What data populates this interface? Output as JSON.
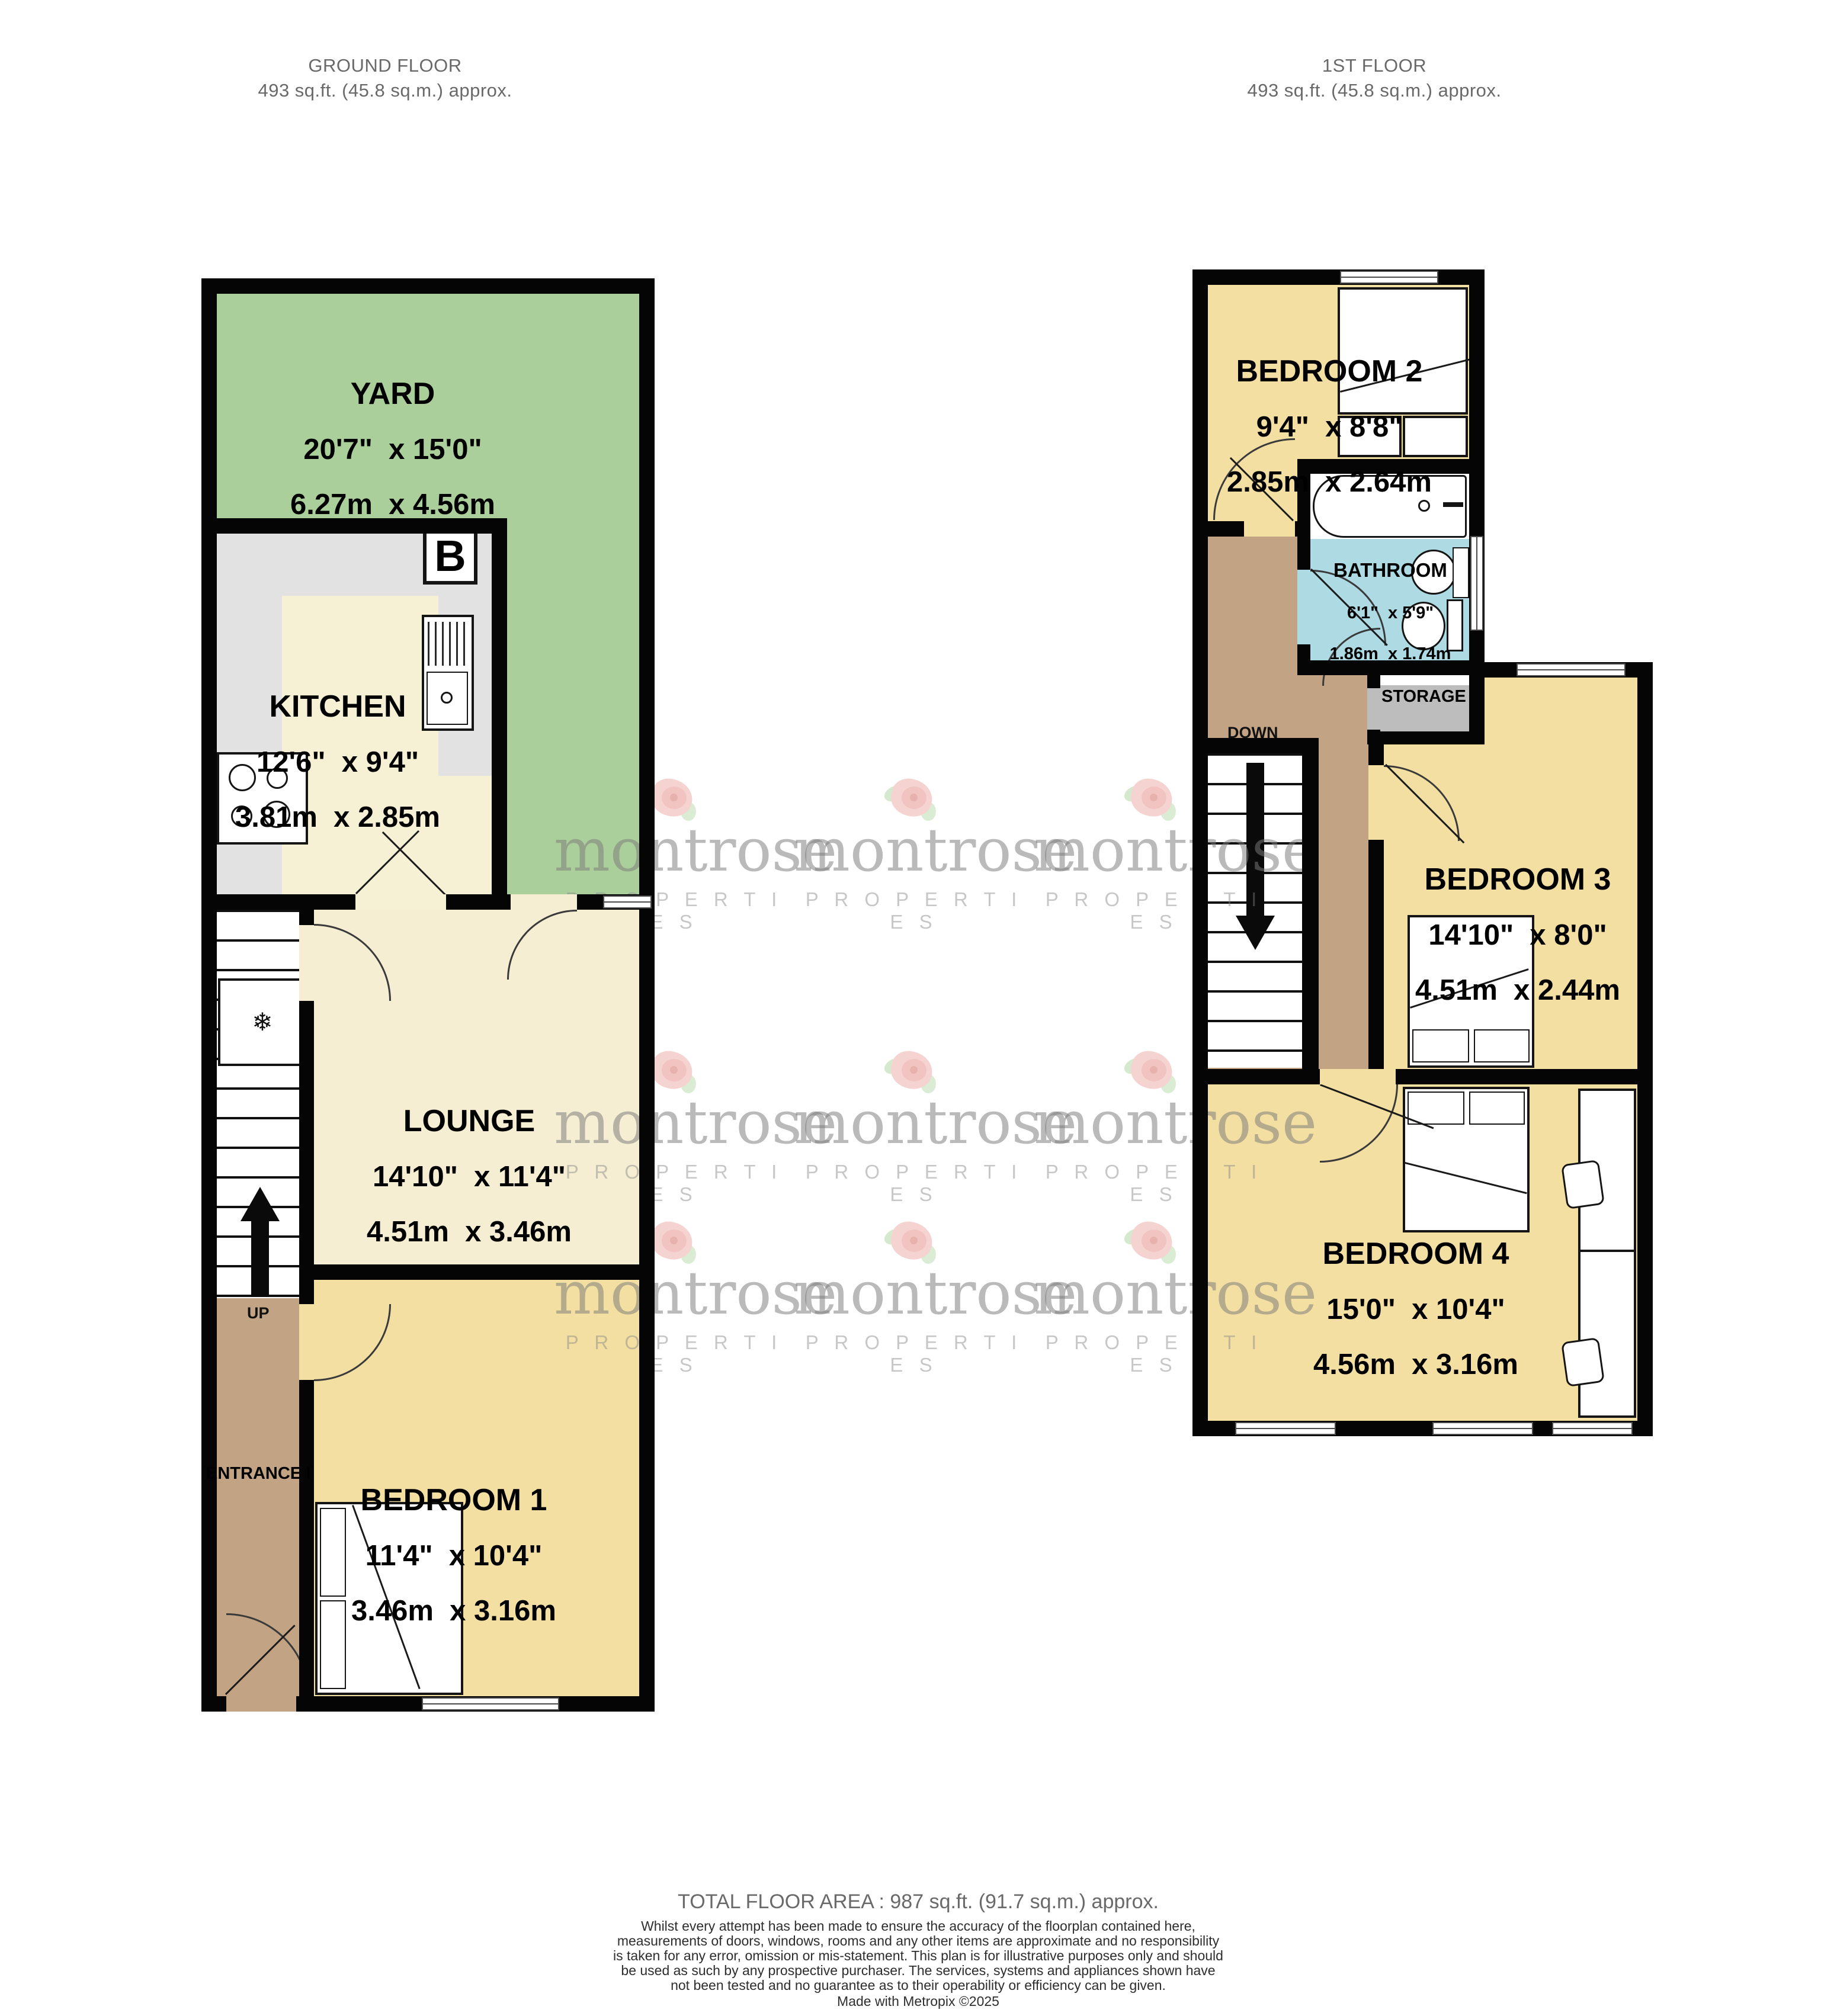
{
  "titles": {
    "ground": {
      "title": "GROUND FLOOR",
      "area": "493 sq.ft. (45.8 sq.m.) approx."
    },
    "first": {
      "title": "1ST FLOOR",
      "area": "493 sq.ft. (45.8 sq.m.) approx."
    }
  },
  "rooms": {
    "yard": {
      "name": "YARD",
      "imperial": "20'7\"  x 15'0\"",
      "metric": "6.27m  x 4.56m"
    },
    "kitchen": {
      "name": "KITCHEN",
      "imperial": "12'6\"  x 9'4\"",
      "metric": "3.81m  x 2.85m"
    },
    "lounge": {
      "name": "LOUNGE",
      "imperial": "14'10\"  x 11'4\"",
      "metric": "4.51m  x 3.46m"
    },
    "bedroom1": {
      "name": "BEDROOM 1",
      "imperial": "11'4\"  x 10'4\"",
      "metric": "3.46m  x 3.16m"
    },
    "bedroom2": {
      "name": "BEDROOM 2",
      "imperial": "9'4\"  x 8'8\"",
      "metric": "2.85m  x 2.64m"
    },
    "bathroom": {
      "name": "BATHROOM",
      "imperial": "6'1\"  x 5'9\"",
      "metric": "1.86m  x 1.74m"
    },
    "bedroom3": {
      "name": "BEDROOM 3",
      "imperial": "14'10\"  x 8'0\"",
      "metric": "4.51m  x 2.44m"
    },
    "bedroom4": {
      "name": "BEDROOM 4",
      "imperial": "15'0\"  x 10'4\"",
      "metric": "4.56m  x 3.16m"
    },
    "entrance_hall": {
      "name": "ENTRANCE HALL"
    },
    "storage": {
      "name": "STORAGE"
    }
  },
  "annotations": {
    "up": "UP",
    "down": "DOWN",
    "boiler": "B"
  },
  "footer": {
    "total": "TOTAL FLOOR AREA : 987 sq.ft. (91.7 sq.m.) approx.",
    "disclaimer": "Whilst every attempt has been made to ensure the accuracy of the floorplan contained here, measurements of doors, windows, rooms and any other items are approximate and no responsibility is taken for any error, omission or mis-statement. This plan is for illustrative purposes only and should be used as such by any prospective purchaser. The services, systems and appliances shown have not been tested and no guarantee as to their operability or efficiency can be given.",
    "credit": "Made with Metropix ©2025"
  },
  "watermark": {
    "word": "montrose",
    "sub": "P R O P E R T I E S"
  },
  "colors": {
    "yard": "#abcf9b",
    "room_cream": "#f5eed3",
    "kitchen_cream": "#f6f0d5",
    "bedroom_yellow": "#f3dfa2",
    "hall_brown": "#c2a384",
    "bathroom_blue": "#aedbe3",
    "storage_gray": "#bdbdbd",
    "counter_gray": "#e2e2e2",
    "wall": "#050505"
  }
}
